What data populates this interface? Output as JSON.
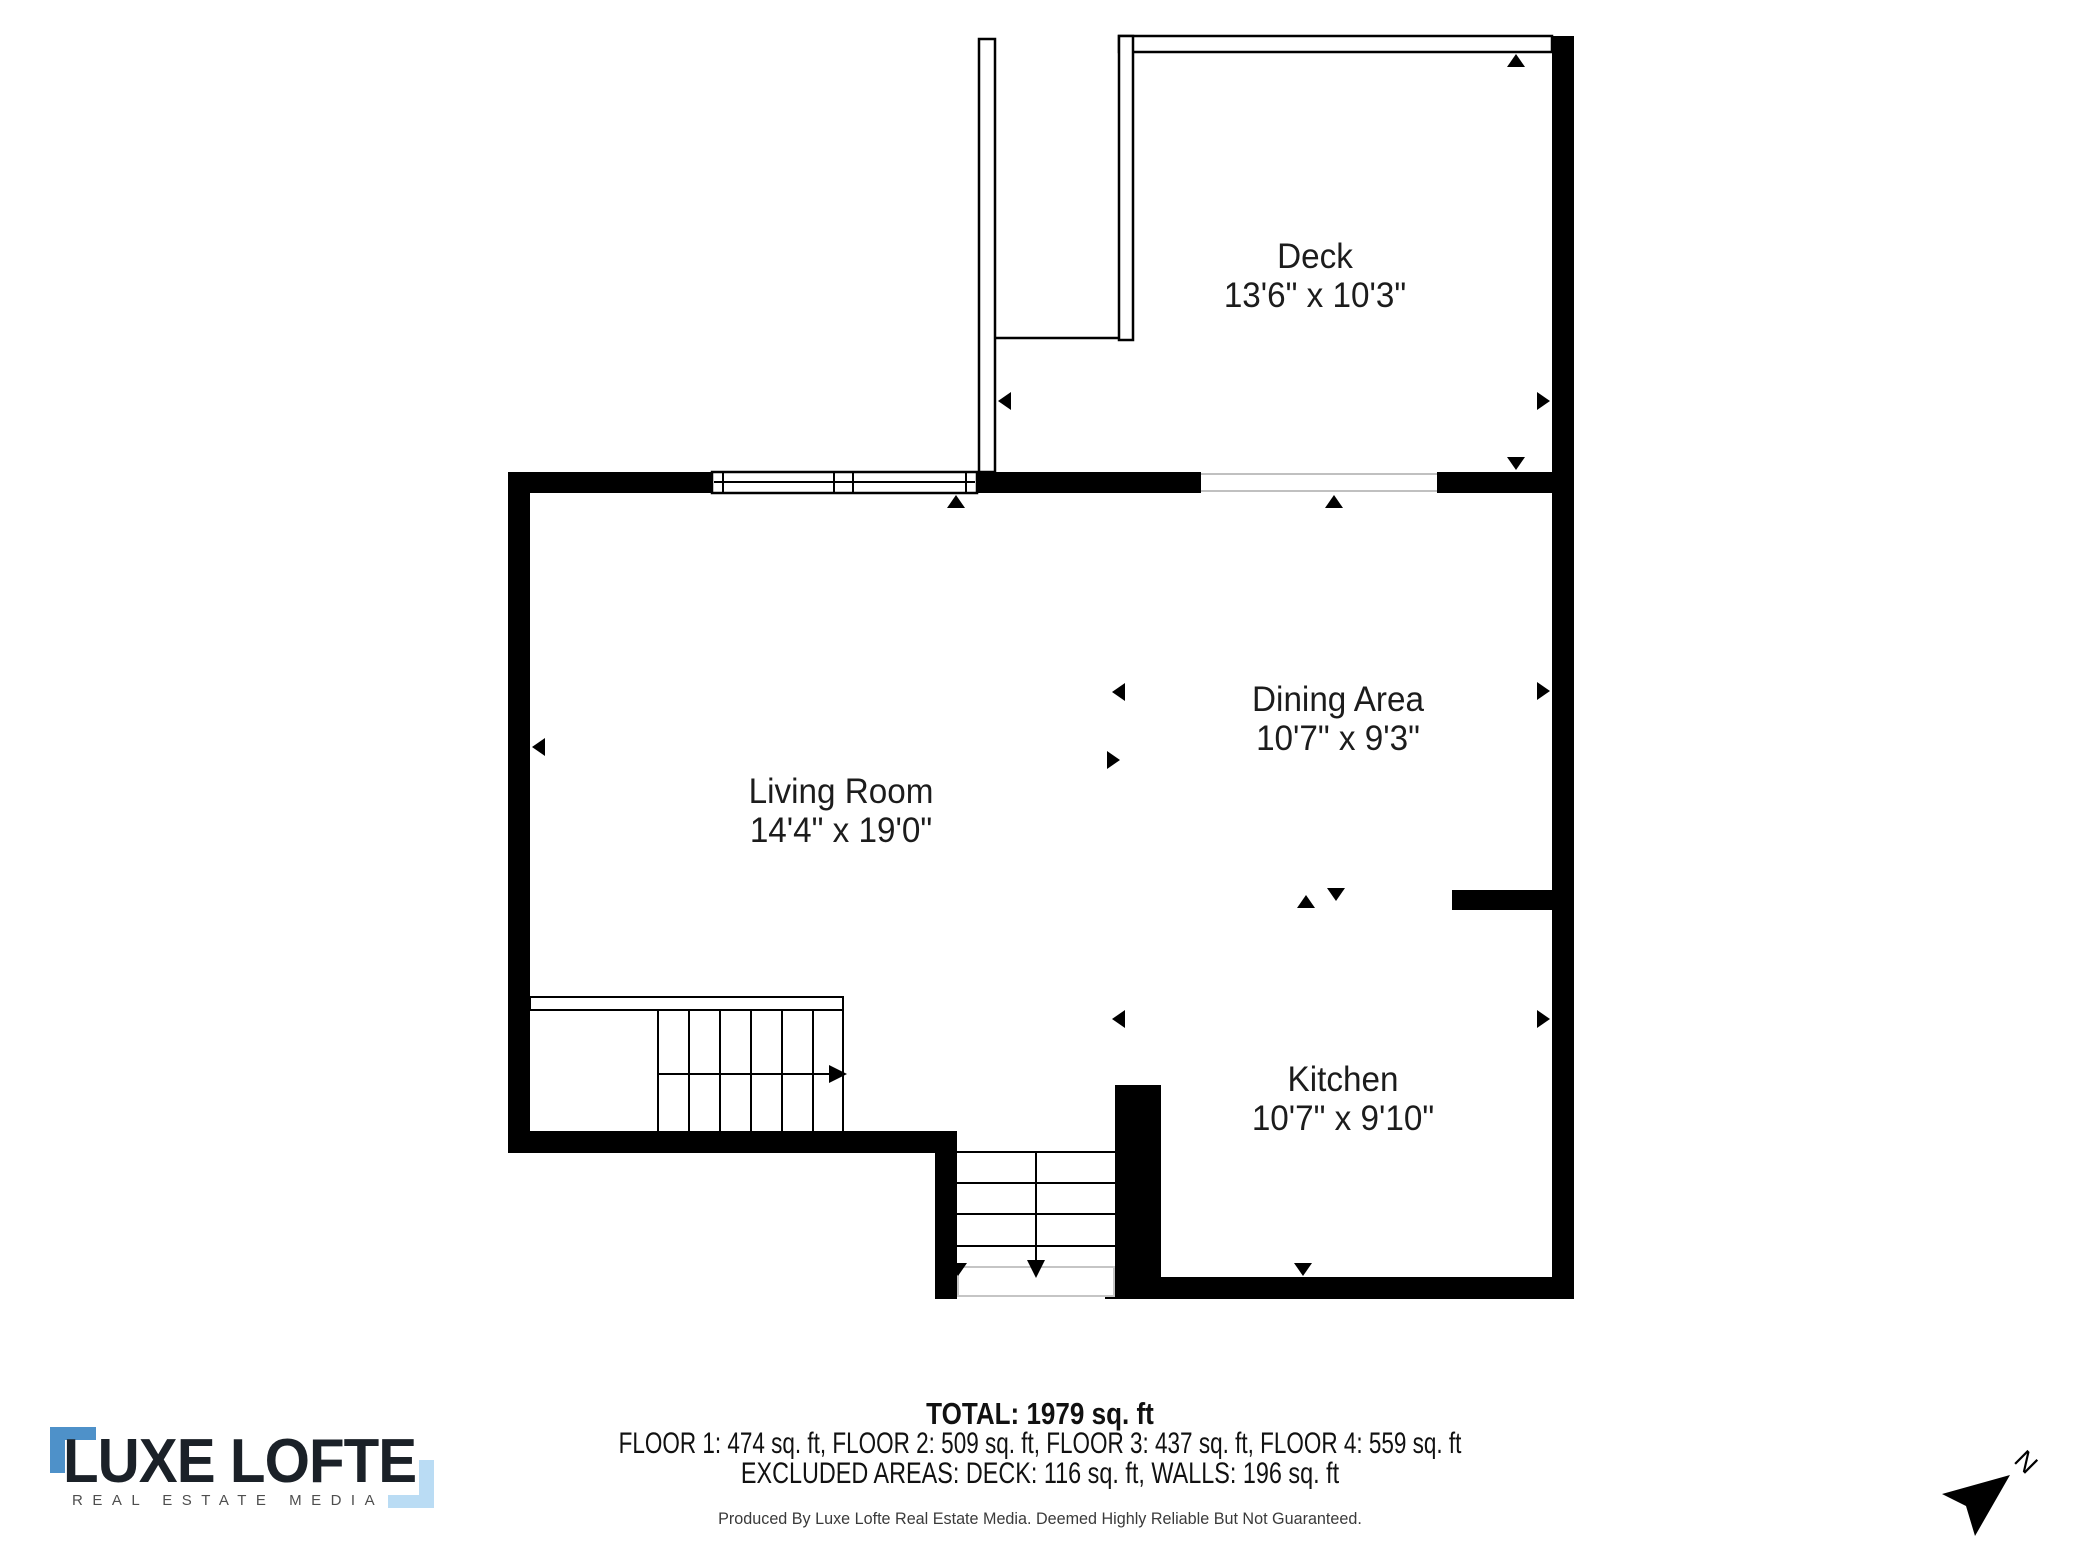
{
  "floor_plan": {
    "rooms": [
      {
        "name": "Deck",
        "dimensions": "13'6\" x 10'3\""
      },
      {
        "name": "Dining Area",
        "dimensions": "10'7\" x 9'3\""
      },
      {
        "name": "Living Room",
        "dimensions": "14'4\" x 19'0\""
      },
      {
        "name": "Kitchen",
        "dimensions": "10'7\" x 9'10\""
      }
    ],
    "compass": {
      "label": "N"
    }
  },
  "summary": {
    "total": "TOTAL: 1979 sq. ft",
    "floor_breakdown": "FLOOR 1: 474 sq. ft, FLOOR 2: 509 sq. ft, FLOOR 3: 437 sq. ft, FLOOR 4: 559 sq. ft",
    "excluded_areas": "EXCLUDED AREAS: DECK: 116 sq. ft, WALLS: 196 sq. ft",
    "disclaimer": "Produced By Luxe Lofte Real Estate Media. Deemed Highly Reliable But Not Guaranteed."
  },
  "branding": {
    "logo_text": "LUXE LOFTE",
    "tagline": "REAL ESTATE MEDIA",
    "accent_blue": "#4e91c9",
    "accent_light_blue": "#badcf4",
    "wall_color": "#000000"
  }
}
